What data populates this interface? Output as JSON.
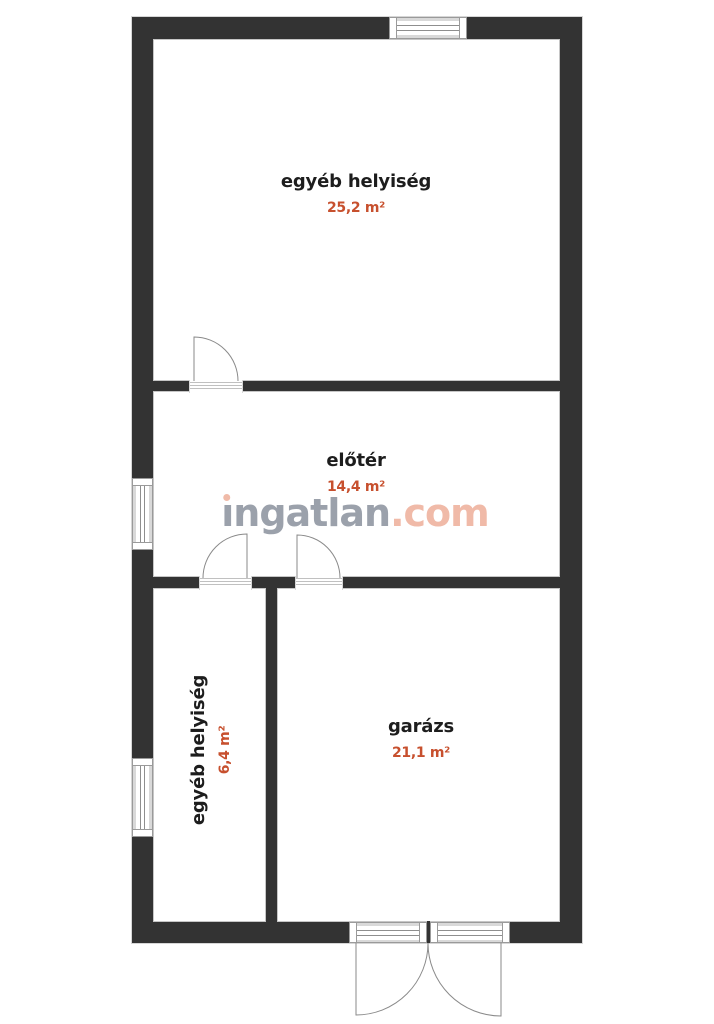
{
  "plan": {
    "rooms": [
      {
        "id": "egyeb-helyiseg-felso",
        "name": "egyéb helyiség",
        "area": "25,2 m²"
      },
      {
        "id": "eloter",
        "name": "előtér",
        "area": "14,4 m²"
      },
      {
        "id": "egyeb-helyiseg-also",
        "name": "egyéb helyiség",
        "area": "6,4 m²"
      },
      {
        "id": "garazs",
        "name": "garázs",
        "area": "21,1 m²"
      }
    ],
    "watermark": {
      "text": "ingatlan.com",
      "stem_display": "ıngatlan",
      "suffix_display": ".com"
    },
    "colors": {
      "wall": "#333333",
      "room_name": "#1d1d1d",
      "area_value": "#c7502e",
      "watermark_gray": "#9ba1ab",
      "watermark_salmon": "#f0baa8"
    }
  }
}
